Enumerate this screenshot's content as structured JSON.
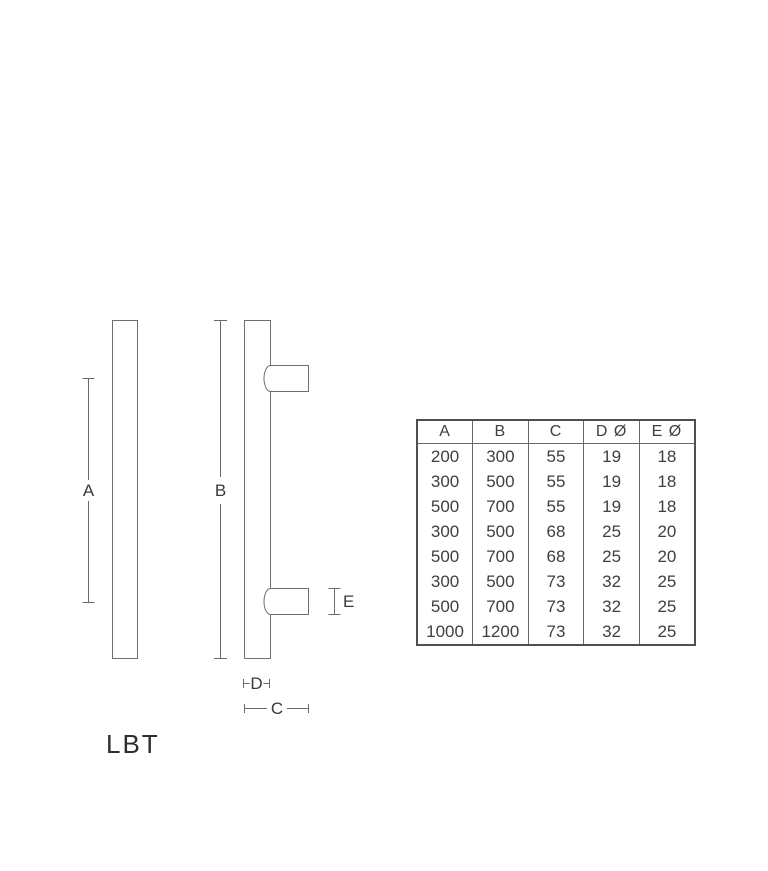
{
  "product": {
    "name": "LBT"
  },
  "diagram": {
    "dim_labels": {
      "a": "A",
      "b": "B",
      "c": "C",
      "d": "D",
      "e": "E"
    }
  },
  "table": {
    "headers": [
      "A",
      "B",
      "C",
      "D Ø",
      "E Ø"
    ],
    "rows": [
      [
        "200",
        "300",
        "55",
        "19",
        "18"
      ],
      [
        "300",
        "500",
        "55",
        "19",
        "18"
      ],
      [
        "500",
        "700",
        "55",
        "19",
        "18"
      ],
      [
        "300",
        "500",
        "68",
        "25",
        "20"
      ],
      [
        "500",
        "700",
        "68",
        "25",
        "20"
      ],
      [
        "300",
        "500",
        "73",
        "32",
        "25"
      ],
      [
        "500",
        "700",
        "73",
        "32",
        "25"
      ],
      [
        "1000",
        "1200",
        "73",
        "32",
        "25"
      ]
    ]
  },
  "colors": {
    "background": "#ffffff",
    "line": "#6e6e6e",
    "text": "#3a3a3a",
    "table_border": "#4f4f4f"
  }
}
